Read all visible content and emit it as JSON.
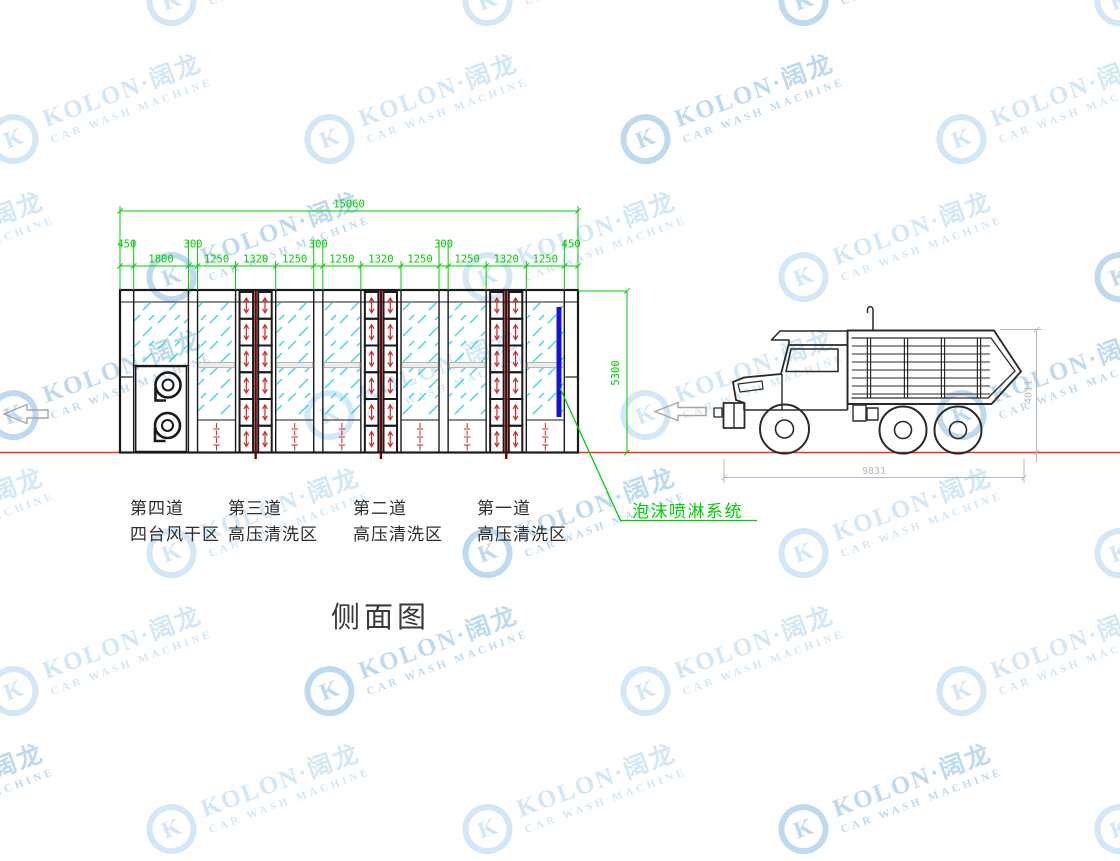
{
  "title": {
    "text": "侧面图"
  },
  "watermark": {
    "brand": "KOLON·阔龙",
    "subtitle": "CAR WASH MACHINE",
    "logo_letter": "K",
    "color_light": "#d2e7f7",
    "color_mid": "#bedaf0"
  },
  "drawing": {
    "colors": {
      "dimension": "#00cf00",
      "structure": "#1a1a1a",
      "glass_hatch": "#3fd9dc",
      "nozzle_red": "#cc2a2a",
      "nozzle_center": "#6e0000",
      "rail_fill": "#ececec",
      "rail_stroke": "#b5b5b5",
      "ground_red": "#e0392b",
      "foam_blue": "#1212dc",
      "truck_line": "#2a2a2a",
      "truck_dim": "#b9b9b9",
      "arrow_gray": "#a6a6a6"
    },
    "dimensions": {
      "total": "15060",
      "segments": [
        "450",
        "1800",
        "300",
        "1250",
        "1320",
        "1250",
        "300",
        "1250",
        "1320",
        "1250",
        "300",
        "1250",
        "1320",
        "1250",
        "450"
      ],
      "height": "5300",
      "truck_length": "9831",
      "truck_height": "4011"
    },
    "zones": [
      {
        "lane": "第四道",
        "area": "四台风干区"
      },
      {
        "lane": "第三道",
        "area": "高压清洗区"
      },
      {
        "lane": "第二道",
        "area": "高压清洗区"
      },
      {
        "lane": "第一道",
        "area": "高压清洗区"
      }
    ],
    "callout": {
      "text": "泡沫喷淋系统"
    }
  }
}
